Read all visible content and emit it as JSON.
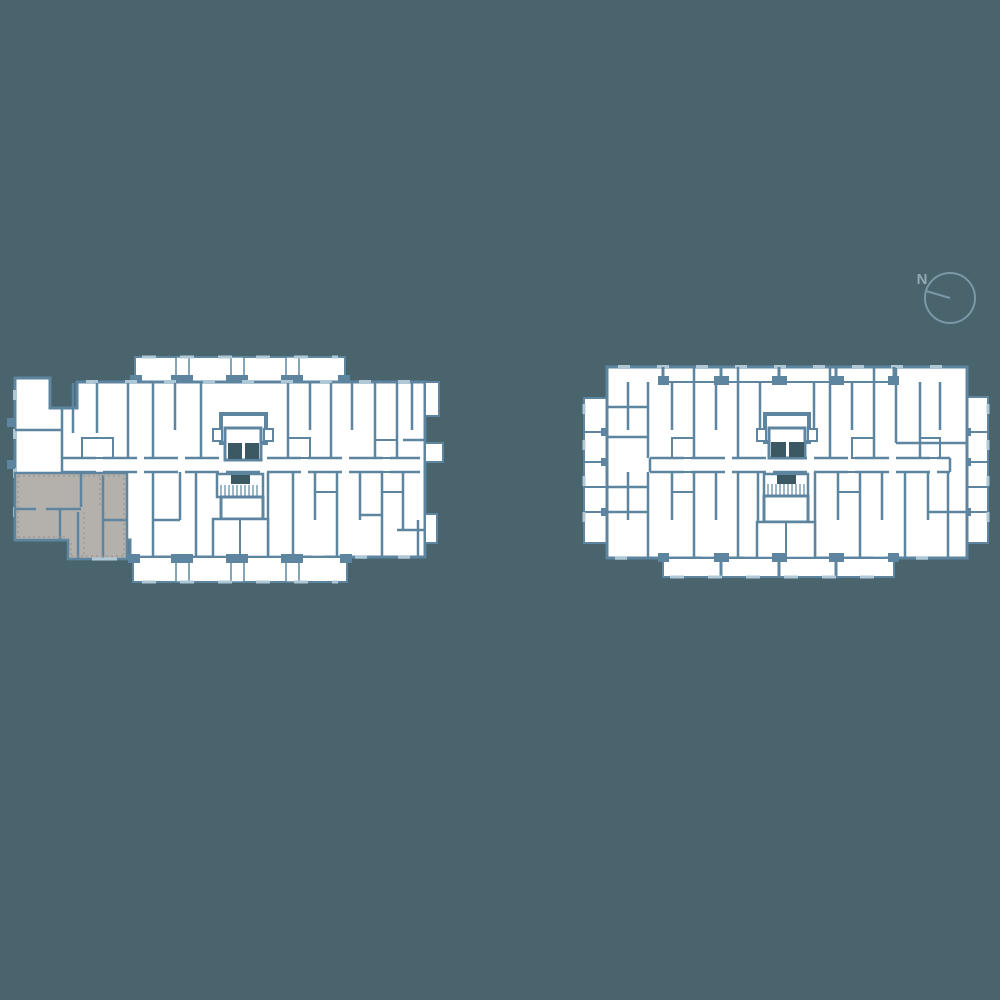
{
  "canvas": {
    "width": 1000,
    "height": 1000
  },
  "colors": {
    "background": "#4A646E",
    "wall": "#5E85A0",
    "wall_light": "#AFC8D6",
    "room_fill": "#FFFFFF",
    "highlight_fill": "#B4B0AC",
    "highlight_dot": "#9D9995",
    "core_dark": "#3C5963",
    "compass_line": "#7C98A6",
    "compass_text": "#93A9B4"
  },
  "compass": {
    "label": "N"
  },
  "floorplans": {
    "left": {
      "name": "left-building-floorplan",
      "has_highlighted_unit": true
    },
    "right": {
      "name": "right-building-floorplan",
      "has_highlighted_unit": false
    }
  }
}
